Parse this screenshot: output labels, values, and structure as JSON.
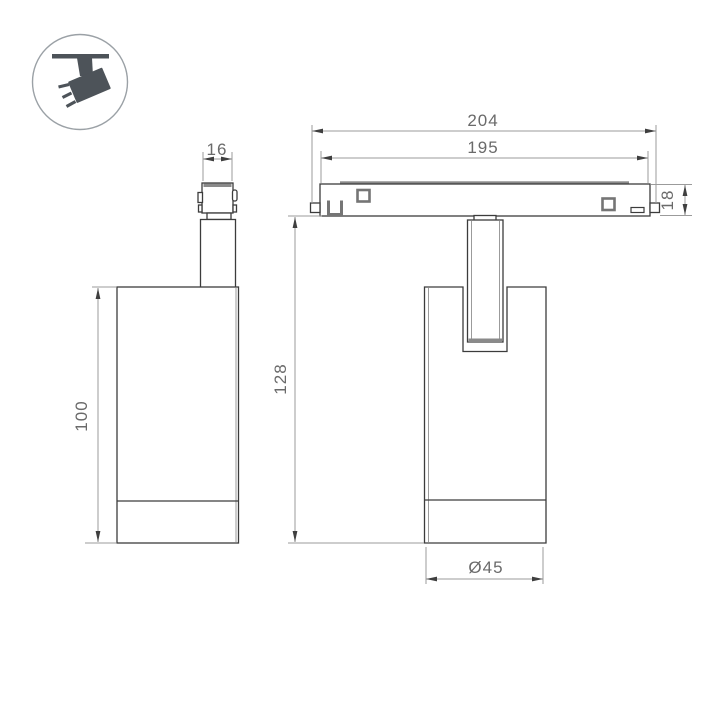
{
  "drawing": {
    "title": "track-spotlight-dimension-drawing",
    "background": "#ffffff",
    "colors": {
      "outline": "#3c3c3c",
      "detail_gray": "#8a8a8a",
      "dimension_line": "#9b9b9b",
      "dimension_text": "#6a6a6a",
      "icon": "#4d5359",
      "icon_circle": "#9ba1a6"
    },
    "icon_badge": {
      "name": "ceiling-track-spotlight-icon"
    },
    "side_view": {
      "name": "spotlight-side-view",
      "dims": {
        "adapter_width": "16",
        "body_height": "100"
      }
    },
    "front_view": {
      "name": "spotlight-front-view",
      "dims": {
        "total_width": "204",
        "track_width": "195",
        "track_height": "18",
        "fixture_height": "128",
        "lamp_diameter": "Ø45"
      }
    }
  }
}
